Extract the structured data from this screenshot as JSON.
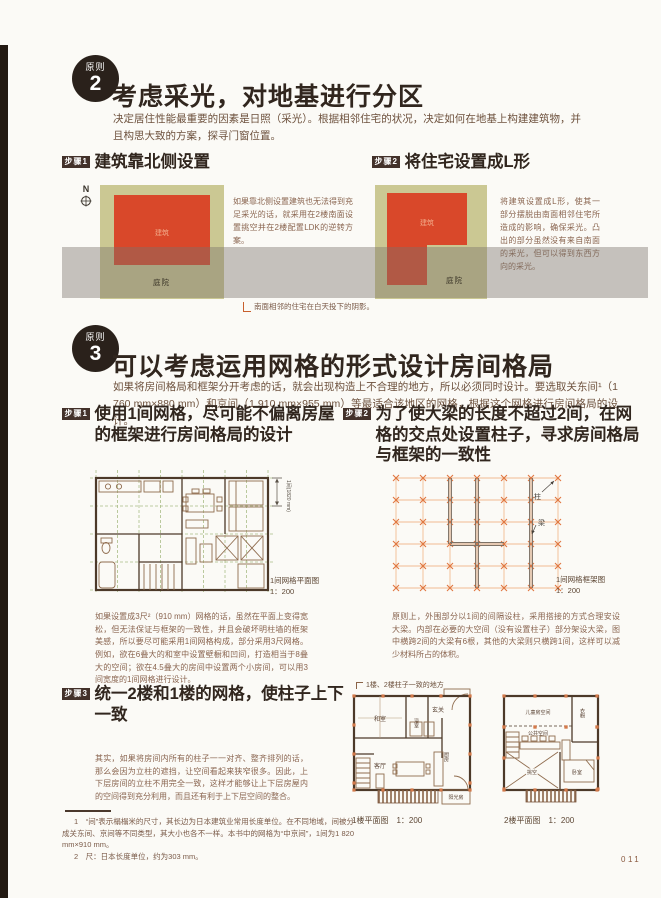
{
  "page": {
    "number": "011"
  },
  "principle2": {
    "badge_label": "原则",
    "badge_number": "2",
    "title": "考虑采光，对地基进行分区",
    "body": "决定居住性能最重要的因素是日照（采光）。根据相邻住宅的状况，决定如何在地基上构建建筑物，并且构思大致的方案，探寻门窗位置。",
    "step1": {
      "badge": "步骤1",
      "title": "建筑靠北侧设置",
      "compass_label": "N",
      "building_label": "建筑",
      "yard_label": "庭院",
      "body": "如果靠北侧设置建筑也无法得到充足采光的话，就采用在2楼南面设置挑空并在2楼配置LDK的逆转方案。"
    },
    "step2": {
      "badge": "步骤2",
      "title": "将住宅设置成L形",
      "building_label": "建筑",
      "yard_label": "庭院",
      "body": "将建筑设置成L形，使其一部分摆脱由南面相邻住宅所造成的影响，确保采光。凸出的部分虽然没有来自南面的采光，但可以得到东西方向的采光。"
    },
    "shadow_caption": "南面相邻的住宅在白天投下的阴影。"
  },
  "principle3": {
    "badge_label": "原则",
    "badge_number": "3",
    "title": "可以考虑运用网格的形式设计房间格局",
    "body": "如果将房间格局和框架分开考虑的话，就会出现构造上不合理的地方，所以必须同时设计。要选取关东间¹（1 760 mm×880 mm）和京间（1 910 mm×955 mm）等最适合该地区的网格，根据这个网格进行房间格局的设计。",
    "step1": {
      "badge": "步骤1",
      "title": "使用1间网格，尽可能不偏离房屋的框架进行房间格局的设计",
      "dim_label": "1间(1820 mm)",
      "caption": "1间网格平面图",
      "scale": "1：200",
      "body": "如果设置成3尺²（910 mm）网格的话，虽然在平面上变得宽松，但无法保证与框架的一致性，并且会破坏明柱墙的框架美感，所以要尽可能采用1间网格构成，部分采用3尺网格。例如，欲在6叠大的和室中设置壁橱和凹间，打造相当于8叠大的空间；欲在4.5叠大的房间中设置两个小房间，可以用3间宽度的1间网格进行设计。"
    },
    "step2": {
      "badge": "步骤2",
      "title": "为了使大梁的长度不超过2间，在网格的交点处设置柱子，寻求房间格局与框架的一致性",
      "column_label": "柱",
      "beam_label": "梁",
      "caption": "1间网格框架图",
      "scale": "1：200",
      "body": "原则上，外围部分以1间的间隔设柱，采用搭接的方式合理安设大梁。内部在必要的大空间（没有设置柱子）部分架设大梁，图中横跨2间的大梁有6根，其他的大梁则只横跨1间，这样可以减少材料所占的体积。"
    },
    "step3": {
      "badge": "步骤3",
      "title": "统一2楼和1楼的网格，使柱子上下一致",
      "body": "其实，如果将房间内所有的柱子一一对齐、整齐排列的话，那么会因为立柱的遮挡，让空间看起来狭窄很多。因此，上下层房间的立柱不用完全一致，这样才能够让上下层房屋内的空间得到充分利用，而且还有利于上下层空间的整合。",
      "annotation": "1楼、2楼柱子一致的地方",
      "floor1": {
        "caption": "1楼平面图　1：200",
        "rooms": {
          "washitsu": "和室",
          "entrance": "玄关",
          "bath": "浴室",
          "living": "客厅",
          "kitchen": "厨房",
          "sunroom": "阳光房"
        }
      },
      "floor2": {
        "caption": "2楼平面图　1：200",
        "rooms": {
          "kids": "儿童房空间",
          "closet": "衣橱",
          "public": "公共空间",
          "bedroom": "卧室",
          "void": "挑空"
        }
      }
    }
  },
  "footnotes": [
    "1　“间”表示榻榻米的尺寸，其长边为日本建筑业常用长度单位。在不同地域，间被分成关东间、京间等不同类型，其大小也各不一样。本书中的网格为“中京间”，1间为1 820 mm×910 mm。",
    "2　尺：日本长度单位，约为303 mm。"
  ]
}
